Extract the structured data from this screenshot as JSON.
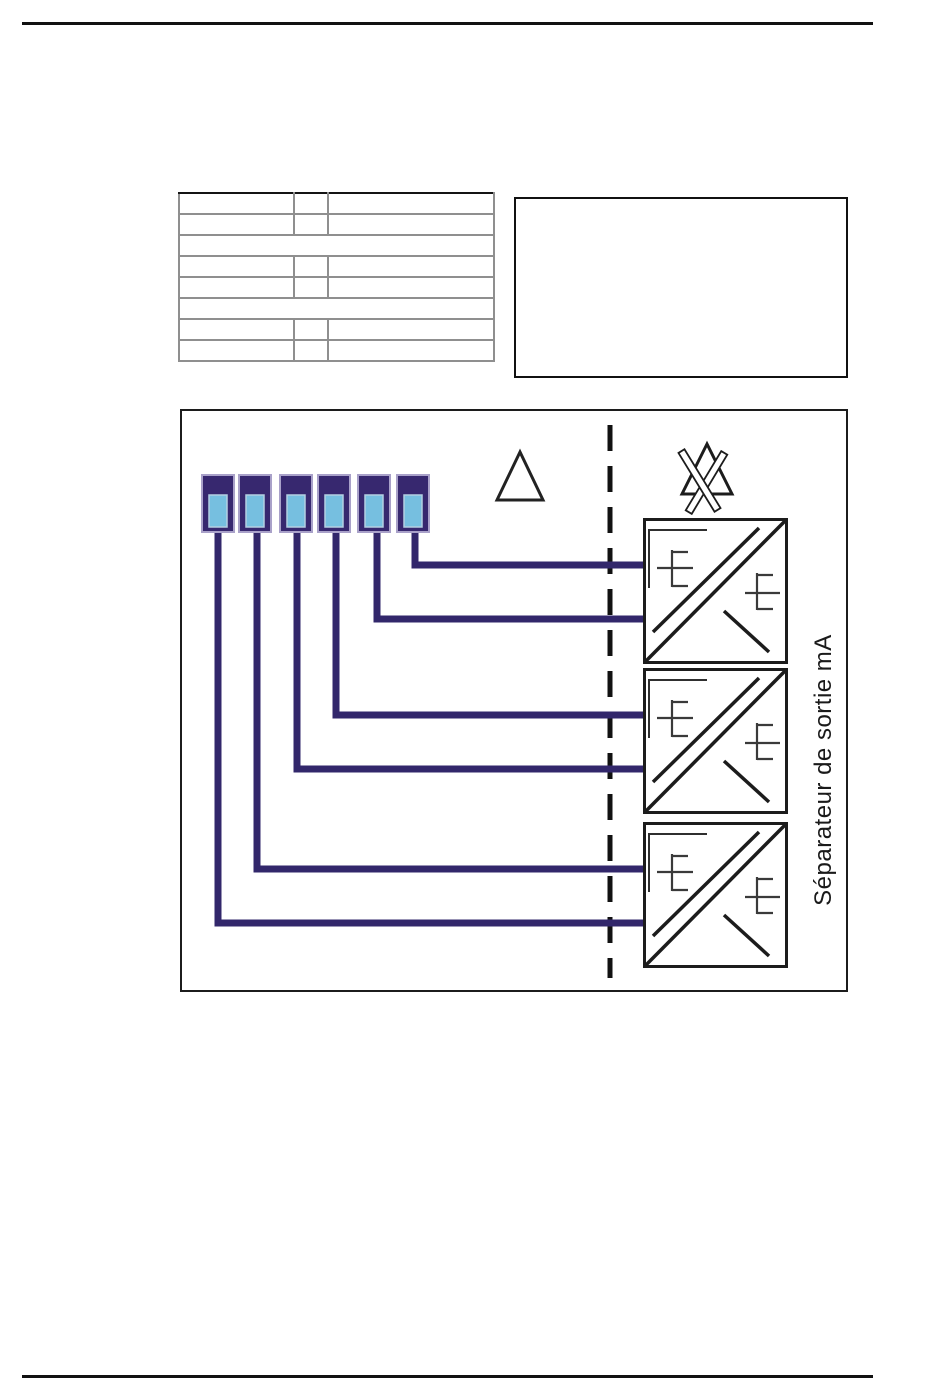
{
  "colors": {
    "wire": "#32276b",
    "terminal_body": "#37286f",
    "terminal_outline": "#a9a1c9",
    "terminal_window": "#76bfe0",
    "window_outline": "#b3cfe2",
    "diagram_line": "#1c1c1c",
    "table_grid": "#8f8f8f",
    "table_grid_strong": "#141414"
  },
  "table": {
    "rows": 8,
    "columns": 3,
    "full_width_rows": [
      3,
      6
    ],
    "content": "empty"
  },
  "note_box": {
    "content": "empty"
  },
  "diagram": {
    "terminals": {
      "count": 6
    },
    "symbols": [
      "warning-triangle",
      "crossed-triangle"
    ],
    "barrier": {
      "style": "vertical-dashed-line"
    },
    "separators": {
      "count": 3,
      "label": "Séparateur de sortie mA"
    },
    "connections": [
      {
        "terminal": 1,
        "separator": 3,
        "port": "lower"
      },
      {
        "terminal": 2,
        "separator": 3,
        "port": "upper"
      },
      {
        "terminal": 3,
        "separator": 2,
        "port": "lower"
      },
      {
        "terminal": 4,
        "separator": 2,
        "port": "upper"
      },
      {
        "terminal": 5,
        "separator": 1,
        "port": "lower"
      },
      {
        "terminal": 6,
        "separator": 1,
        "port": "upper"
      }
    ]
  }
}
